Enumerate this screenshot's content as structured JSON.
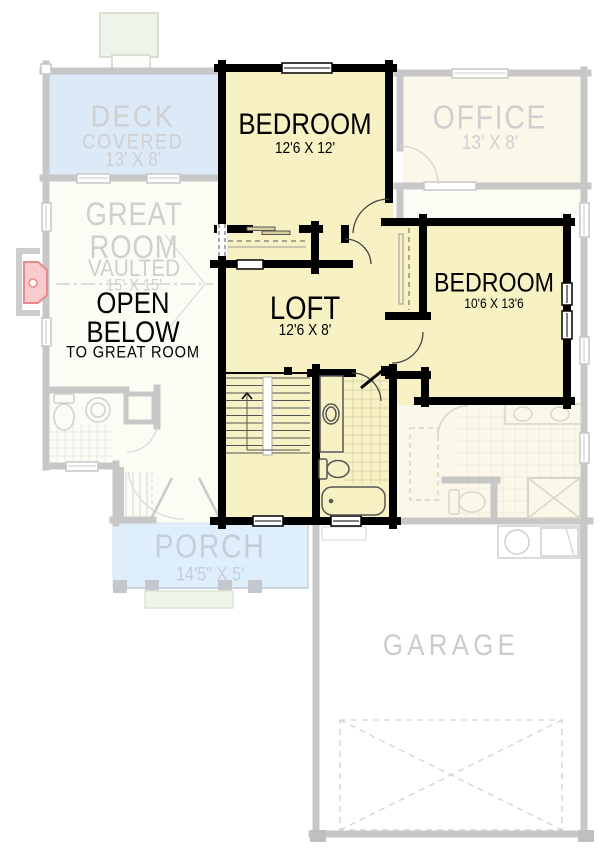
{
  "title": "Upper Floor Plan",
  "colors": {
    "highlight_fill": "#F7F1C3",
    "highlight_wall": "#000000",
    "faded_wall": "#C7C7C7",
    "faded_room_fill": "#FBF8E9",
    "floor_fill": "#FDFCF4",
    "deck_fill": "#DCEAF7",
    "porch_fill": "#DFEEFB",
    "faded_text": "#CFCFCF",
    "porch_text": "#C3CEDB",
    "fireplace_red": "#E98A8A"
  },
  "rooms": {
    "deck": {
      "name": "DECK",
      "type": "COVERED",
      "dims": "13' X 8'"
    },
    "great_room": {
      "line1": "GREAT",
      "line2": "ROOM",
      "type": "VAULTED",
      "dims": "15' X 15'"
    },
    "open_below": {
      "line1": "OPEN",
      "line2": "BELOW",
      "note": "TO GREAT ROOM"
    },
    "bedroom_top": {
      "name": "BEDROOM",
      "dims": "12'6 X 12'"
    },
    "office": {
      "name": "OFFICE",
      "dims": "13' X 8'"
    },
    "bedroom_right": {
      "name": "BEDROOM",
      "dims": "10'6 X 13'6"
    },
    "loft": {
      "name": "LOFT",
      "dims": "12'6 X 8'"
    },
    "porch": {
      "name": "PORCH",
      "dims": "14'5\" X 5'"
    },
    "garage": {
      "name": "GARAGE"
    }
  }
}
